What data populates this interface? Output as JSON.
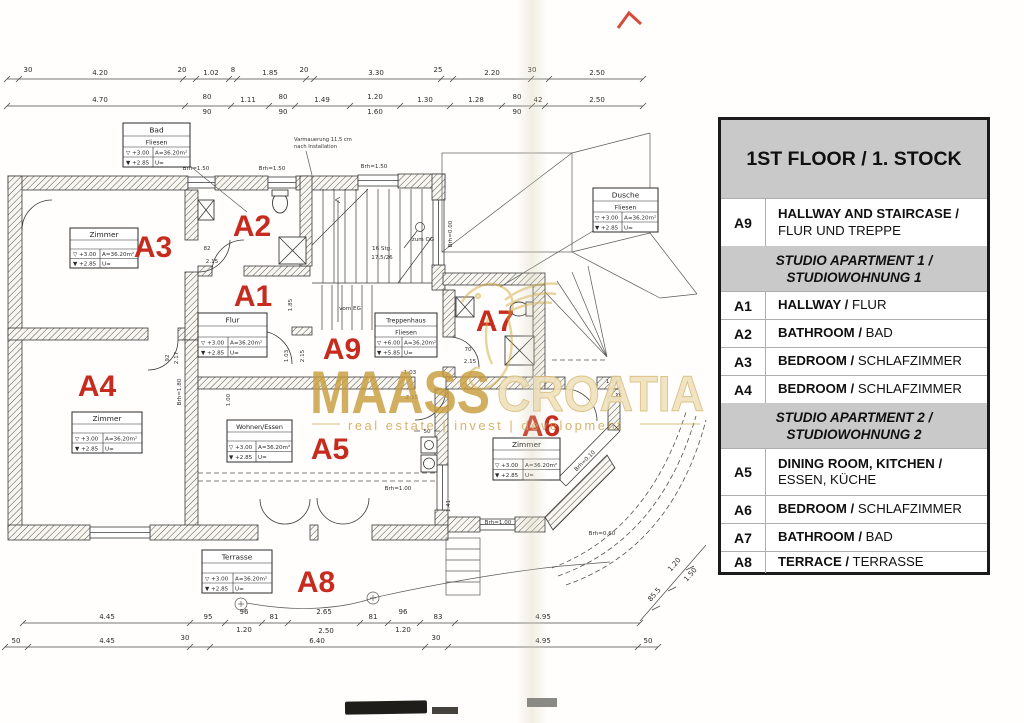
{
  "legend": {
    "title": "1ST FLOOR / 1. STOCK",
    "a9": {
      "code": "A9",
      "en": "HALLWAY AND STAIRCASE /",
      "de": "FLUR UND TREPPE"
    },
    "sec1": {
      "l1": "STUDIO APARTMENT 1 /",
      "l2": "STUDIOWOHNUNG 1"
    },
    "a1": {
      "code": "A1",
      "en": "HALLWAY /",
      "de": "FLUR"
    },
    "a2": {
      "code": "A2",
      "en": "BATHROOM /",
      "de": "BAD"
    },
    "a3": {
      "code": "A3",
      "en": "BEDROOM /",
      "de": "SCHLAFZIMMER"
    },
    "a4": {
      "code": "A4",
      "en": "BEDROOM /",
      "de": "SCHLAFZIMMER"
    },
    "sec2": {
      "l1": "STUDIO APARTMENT 2 /",
      "l2": "STUDIOWOHNUNG 2"
    },
    "a5": {
      "code": "A5",
      "en": "DINING ROOM, KITCHEN /",
      "de": "ESSEN, KÜCHE"
    },
    "a6": {
      "code": "A6",
      "en": "BEDROOM /",
      "de": "SCHLAFZIMMER"
    },
    "a7": {
      "code": "A7",
      "en": "BATHROOM /",
      "de": "BAD"
    },
    "a8": {
      "code": "A8",
      "en": "TERRACE /",
      "de": "TERRASSE"
    }
  },
  "plan": {
    "codes": {
      "a1": "A1",
      "a2": "A2",
      "a3": "A3",
      "a4": "A4",
      "a5": "A5",
      "a6": "A6",
      "a7": "A7",
      "a8": "A8",
      "a9": "A9"
    },
    "boxes": {
      "bad": {
        "title": "Bad",
        "mat": "Fliesen",
        "lvl1": "▽ +3.00",
        "area": "A=36.20m²",
        "lvl2": "▼ +2.85",
        "u": "U="
      },
      "zimmer_a3": {
        "title": "Zimmer",
        "mat": "",
        "lvl1": "▽ +3.00",
        "area": "A=36.20m²",
        "lvl2": "▼ +2.85",
        "u": "U="
      },
      "flur": {
        "title": "Flur",
        "mat": "",
        "lvl1": "▽ +3.00",
        "area": "A=36.20m²",
        "lvl2": "▼ +2.85",
        "u": "U="
      },
      "treppenhaus": {
        "title": "Treppenhaus",
        "mat": "Fliesen",
        "lvl1": "▽ +6.00",
        "area": "A=36.20m²",
        "lvl2": "▼ +5.85",
        "u": "U="
      },
      "dusche": {
        "title": "Dusche",
        "mat": "Fliesen",
        "lvl1": "▽ +3.00",
        "area": "A=36.20m²",
        "lvl2": "▼ +2.85",
        "u": "U="
      },
      "zimmer_a4": {
        "title": "Zimmer",
        "mat": "",
        "lvl1": "▽ +3.00",
        "area": "A=36.20m²",
        "lvl2": "▼ +2.85",
        "u": "U="
      },
      "wohnen": {
        "title": "Wohnen/Essen",
        "mat": "",
        "lvl1": "▽ +3.00",
        "area": "A=36.20m²",
        "lvl2": "▼ +2.85",
        "u": "U="
      },
      "zimmer_a6": {
        "title": "Zimmer",
        "mat": "",
        "lvl1": "▽ +3.00",
        "area": "A=36.20m²",
        "lvl2": "▼ +2.85",
        "u": "U="
      },
      "terrasse": {
        "title": "Terrasse",
        "mat": "",
        "lvl1": "▽ +3.00",
        "area": "A=36.20m²",
        "lvl2": "▼ +2.85",
        "u": "U="
      }
    },
    "stair": {
      "line1": "16 Stg.",
      "line2": "17,5/26",
      "zum": "zum OG",
      "vom": "vom EG"
    },
    "note1": "Varmauerung 11,5 cm",
    "note2": "nach Installation",
    "labels": {
      "brh150": "Brh=1.50",
      "brh100": "Brh=1.00",
      "brh000": "Brh=0.00",
      "brh060": "Brh=0.60",
      "brh010": "Brh=0.10",
      "brh180": "Brh=1.80"
    },
    "doors": {
      "d82": "82",
      "d215": "2.15",
      "d92": "92",
      "d217": "2.17",
      "d103": "1.03",
      "d70": "70",
      "d50": "50"
    },
    "vdims": {
      "v185": "1.85",
      "v103": "1.03",
      "v215": "2.15",
      "v100": "1.00",
      "v141": "1.41"
    },
    "dims": {
      "t1": [
        "30",
        "4.20",
        "20",
        "1.02",
        "8",
        "1.85",
        "20",
        "3.30",
        "25",
        "2.20",
        "30",
        "2.50"
      ],
      "t2": [
        "4.70",
        "80",
        "90",
        "1.11",
        "80",
        "90",
        "1.49",
        "1.20",
        "1.60",
        "1.30",
        "1.28",
        "80",
        "90",
        "42",
        "2.50"
      ],
      "b1": [
        "4.45",
        "95",
        "96",
        "1.20",
        "81",
        "2.65",
        "2.50",
        "81",
        "96",
        "1.20",
        "83",
        "4.95"
      ],
      "b2": [
        "50",
        "4.45",
        "30",
        "6.40",
        "30",
        "4.95",
        "50"
      ],
      "diag": [
        "85.5",
        "1.20",
        "1.50"
      ]
    }
  },
  "watermark": {
    "bold": "MAASS",
    "light": "CROATIA",
    "tagline": "real estate | invest | development"
  }
}
